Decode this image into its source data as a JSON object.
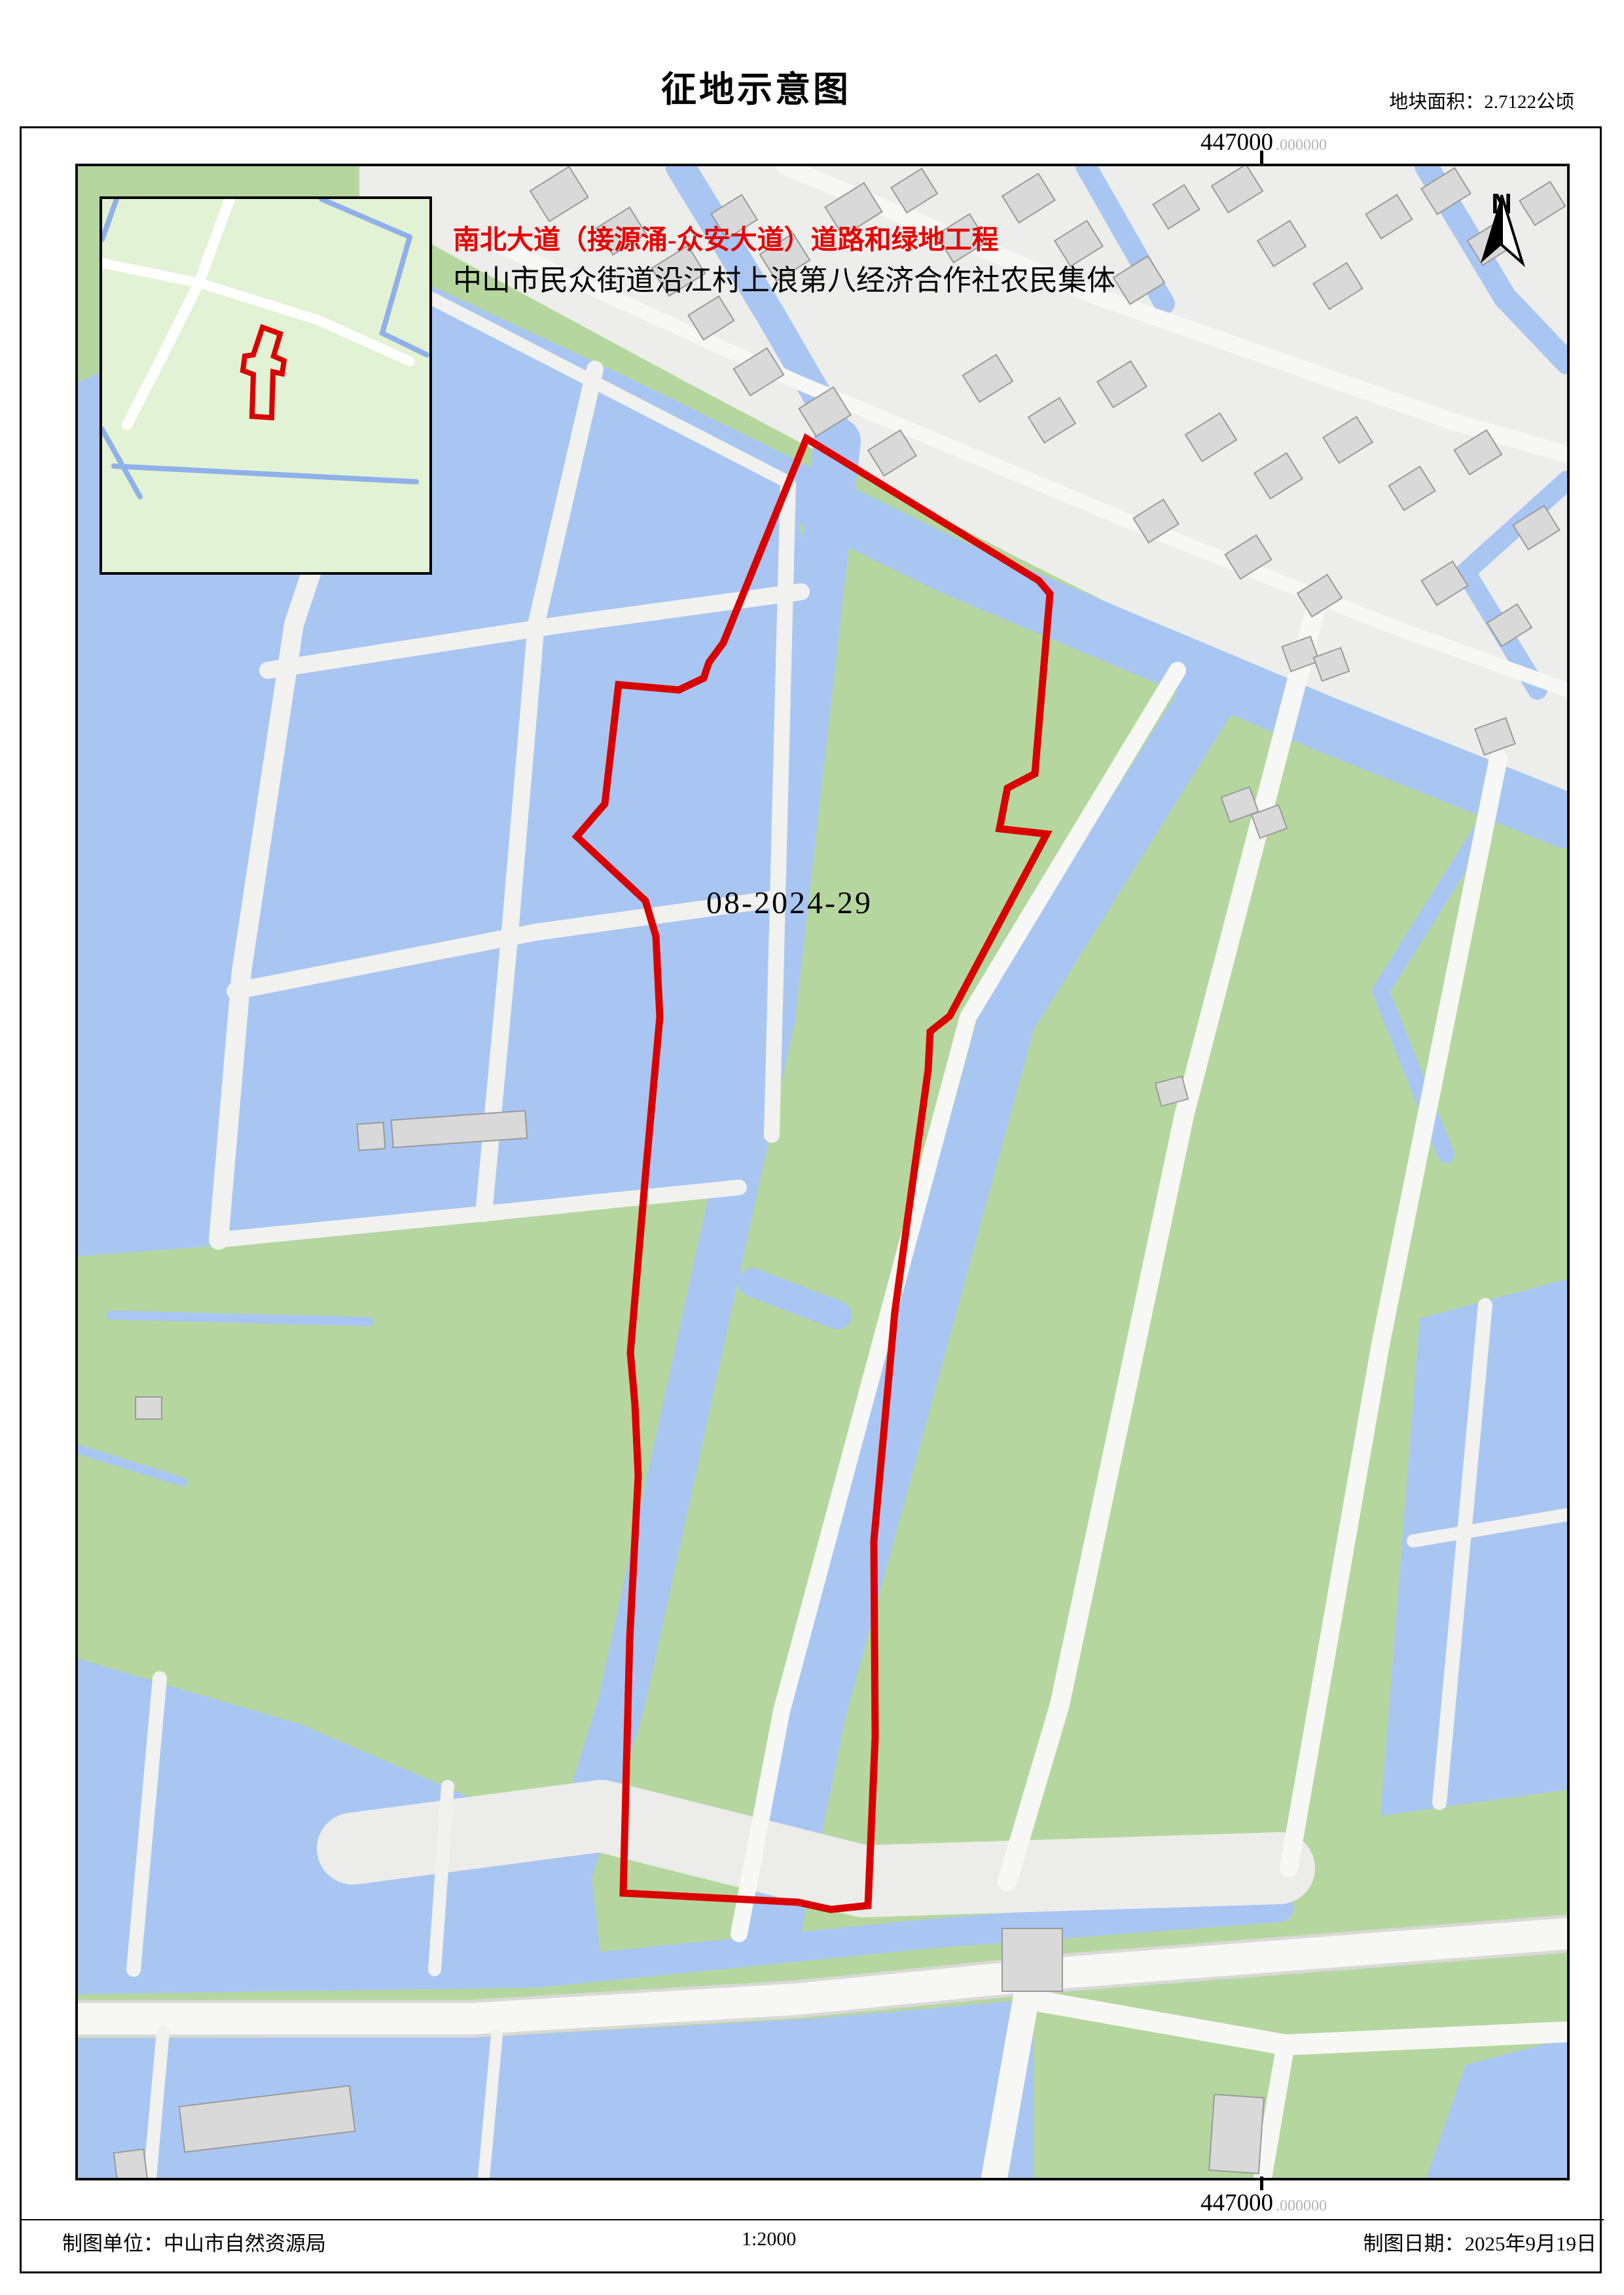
{
  "page": {
    "title": "征地示意图",
    "area_note": "地块面积：2.7122公顷"
  },
  "grid": {
    "top_coordinate": "447000",
    "top_coordinate_decimal": ".000000",
    "bottom_coordinate": "447000",
    "bottom_coordinate_decimal": ".000000"
  },
  "map_labels": {
    "project": "南北大道（接源涌-众安大道）道路和绿地工程",
    "owner": "中山市民众街道沿江村上浪第八经济合作社农民集体",
    "parcel_id": "08-2024-29",
    "north": "N"
  },
  "footer": {
    "maker": "制图单位：中山市自然资源局",
    "scale": "1:2000",
    "date": "制图日期：2025年9月19日"
  },
  "colors": {
    "boundary_red": "#d90000",
    "water_blue": "#a9c6f2",
    "land_green": "#b5d79f",
    "village_gray": "#ededeb",
    "road_white": "#f7f7f5",
    "building_gray": "#d9d9d9",
    "inset_green": "#e2f2d4",
    "coord_decimal_gray": "#b4b4b4"
  }
}
